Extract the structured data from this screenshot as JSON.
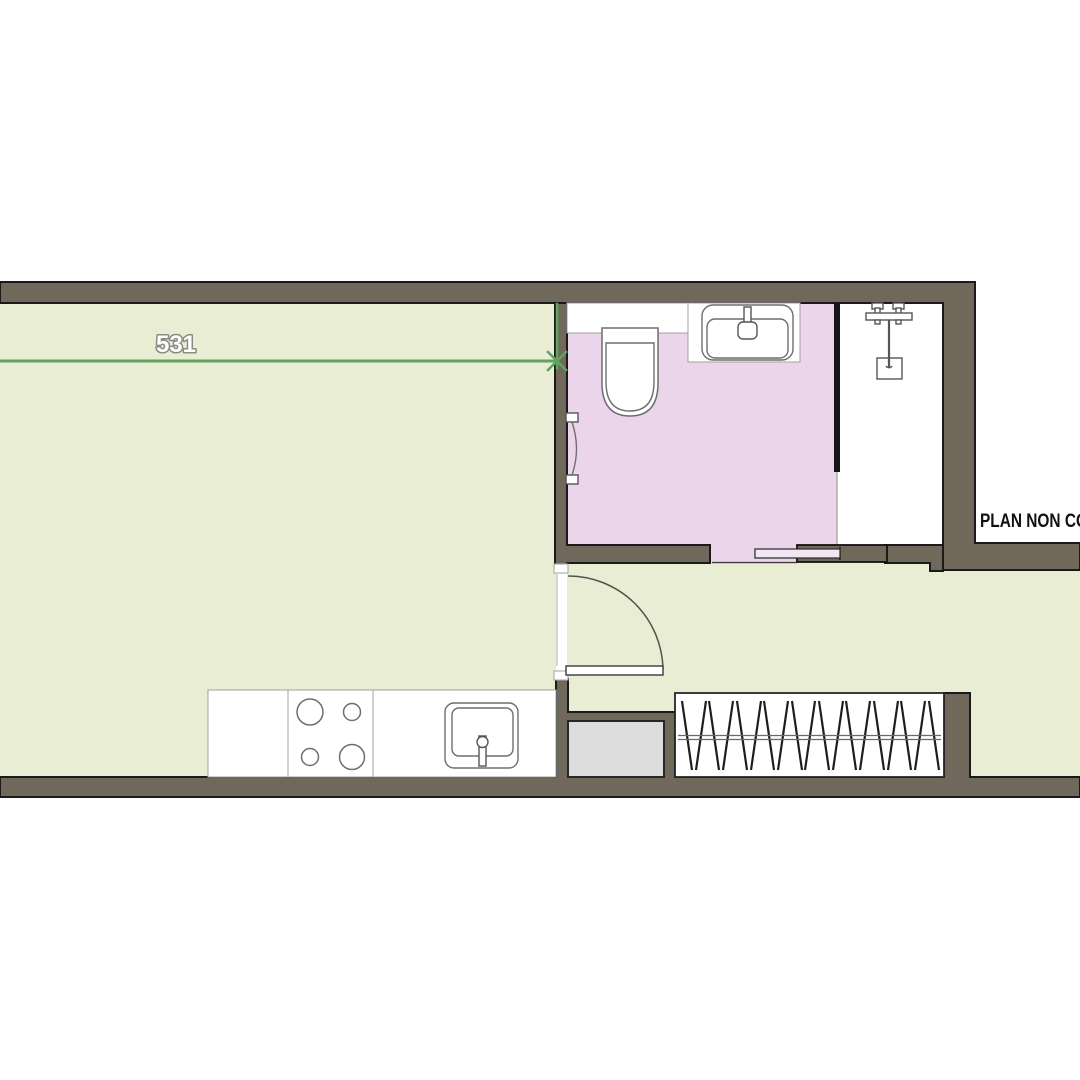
{
  "plan": {
    "dimension": {
      "label": "531"
    },
    "note": {
      "text": "PLAN NON CO"
    },
    "colors": {
      "background": "#ffffff",
      "wall_fill": "#6f685b",
      "wall_outline": "#1a1a1a",
      "floor_main": "#e9edd3",
      "floor_bathroom": "#ebd5eb",
      "floor_shower": "#ffffff",
      "sliding_door_leaf": "#f3e6f3",
      "appliance_gray": "#dcdcdc",
      "shower_partition": "#151515",
      "dimension_green": "#5fa45f",
      "dimension_text_fill": "#ffffff",
      "dimension_text_outline": "#8b8b84",
      "note_color": "#111111"
    }
  }
}
